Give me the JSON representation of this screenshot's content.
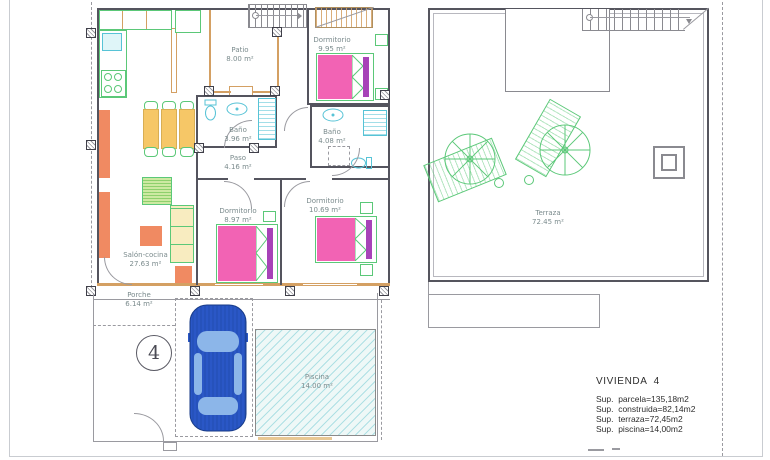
{
  "drawing": {
    "type": "architectural-floor-plan",
    "unit_marker": "4",
    "colors": {
      "wall": "#54545e",
      "partition_tan": "#d4a063",
      "furniture_green": "#5bc878",
      "furniture_orange": "#f08a62",
      "furniture_yellow": "#f6c767",
      "bed_pink": "#f263b4",
      "bed_purple": "#a743b8",
      "fixture_cyan": "#57c3d6",
      "pool_fill": "#eef8f7",
      "car_blue": "#2a57c6",
      "car_window": "#8cb6e9",
      "label_gray": "#7b8b8d"
    }
  },
  "floor_plan": {
    "rooms": [
      {
        "id": "patio",
        "label": "Patio",
        "area": "8.00 m²"
      },
      {
        "id": "dormitorio-995",
        "label": "Dormitorio",
        "area": "9.95 m²"
      },
      {
        "id": "bano-396",
        "label": "Baño",
        "area": "3.96 m²"
      },
      {
        "id": "bano-408",
        "label": "Baño",
        "area": "4.08 m²"
      },
      {
        "id": "paso",
        "label": "Paso",
        "area": "4.16 m²"
      },
      {
        "id": "dormitorio-897",
        "label": "Dormitorio",
        "area": "8.97 m²"
      },
      {
        "id": "dormitorio-1069",
        "label": "Dormitorio",
        "area": "10.69 m²"
      },
      {
        "id": "salon-cocina",
        "label": "Salón-cocina",
        "area": "27.63 m²"
      },
      {
        "id": "porche",
        "label": "Porche",
        "area": "6.14 m²"
      },
      {
        "id": "piscina",
        "label": "Piscina",
        "area": "14.00 m²"
      },
      {
        "id": "terraza",
        "label": "Terraza",
        "area": "72.45 m²"
      }
    ],
    "unit_marker": "4"
  },
  "summary": {
    "title": "VIVIENDA  4",
    "lines": [
      "Sup.  parcela=135,18m2",
      "Sup.  construida=82,14m2",
      "Sup.  terraza=72,45m2",
      "Sup.  piscina=14,00m2"
    ]
  }
}
